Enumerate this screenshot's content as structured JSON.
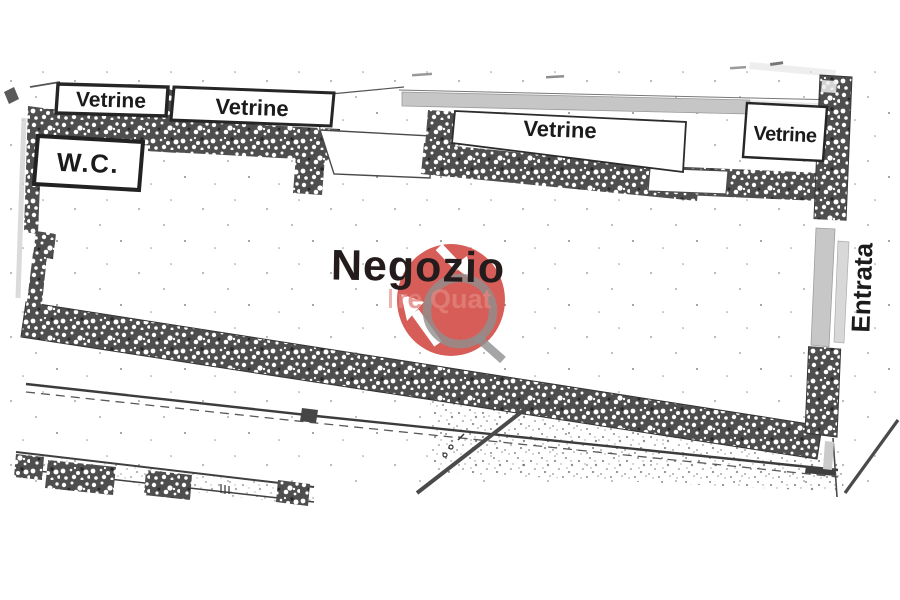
{
  "plan": {
    "shop_label": "Negozio",
    "wc_label": "W.C.",
    "entrance_label": "Entrata",
    "window_labels": [
      "Vetrine",
      "Vetrine",
      "Vetrine",
      "Vetrine"
    ]
  },
  "watermark": {
    "visible_text": "re Quat"
  },
  "colors": {
    "wall": "#4e4e4e",
    "ink": "#1b1b1b",
    "shop_ink": "#241b1d",
    "watermark_red": "#d4524b",
    "watermark_gray": "#8f8f8f",
    "watermark_faint_red": "#e2837c",
    "sill_gray": "#c6c6c6",
    "door_gray": "#c7c7c7"
  }
}
